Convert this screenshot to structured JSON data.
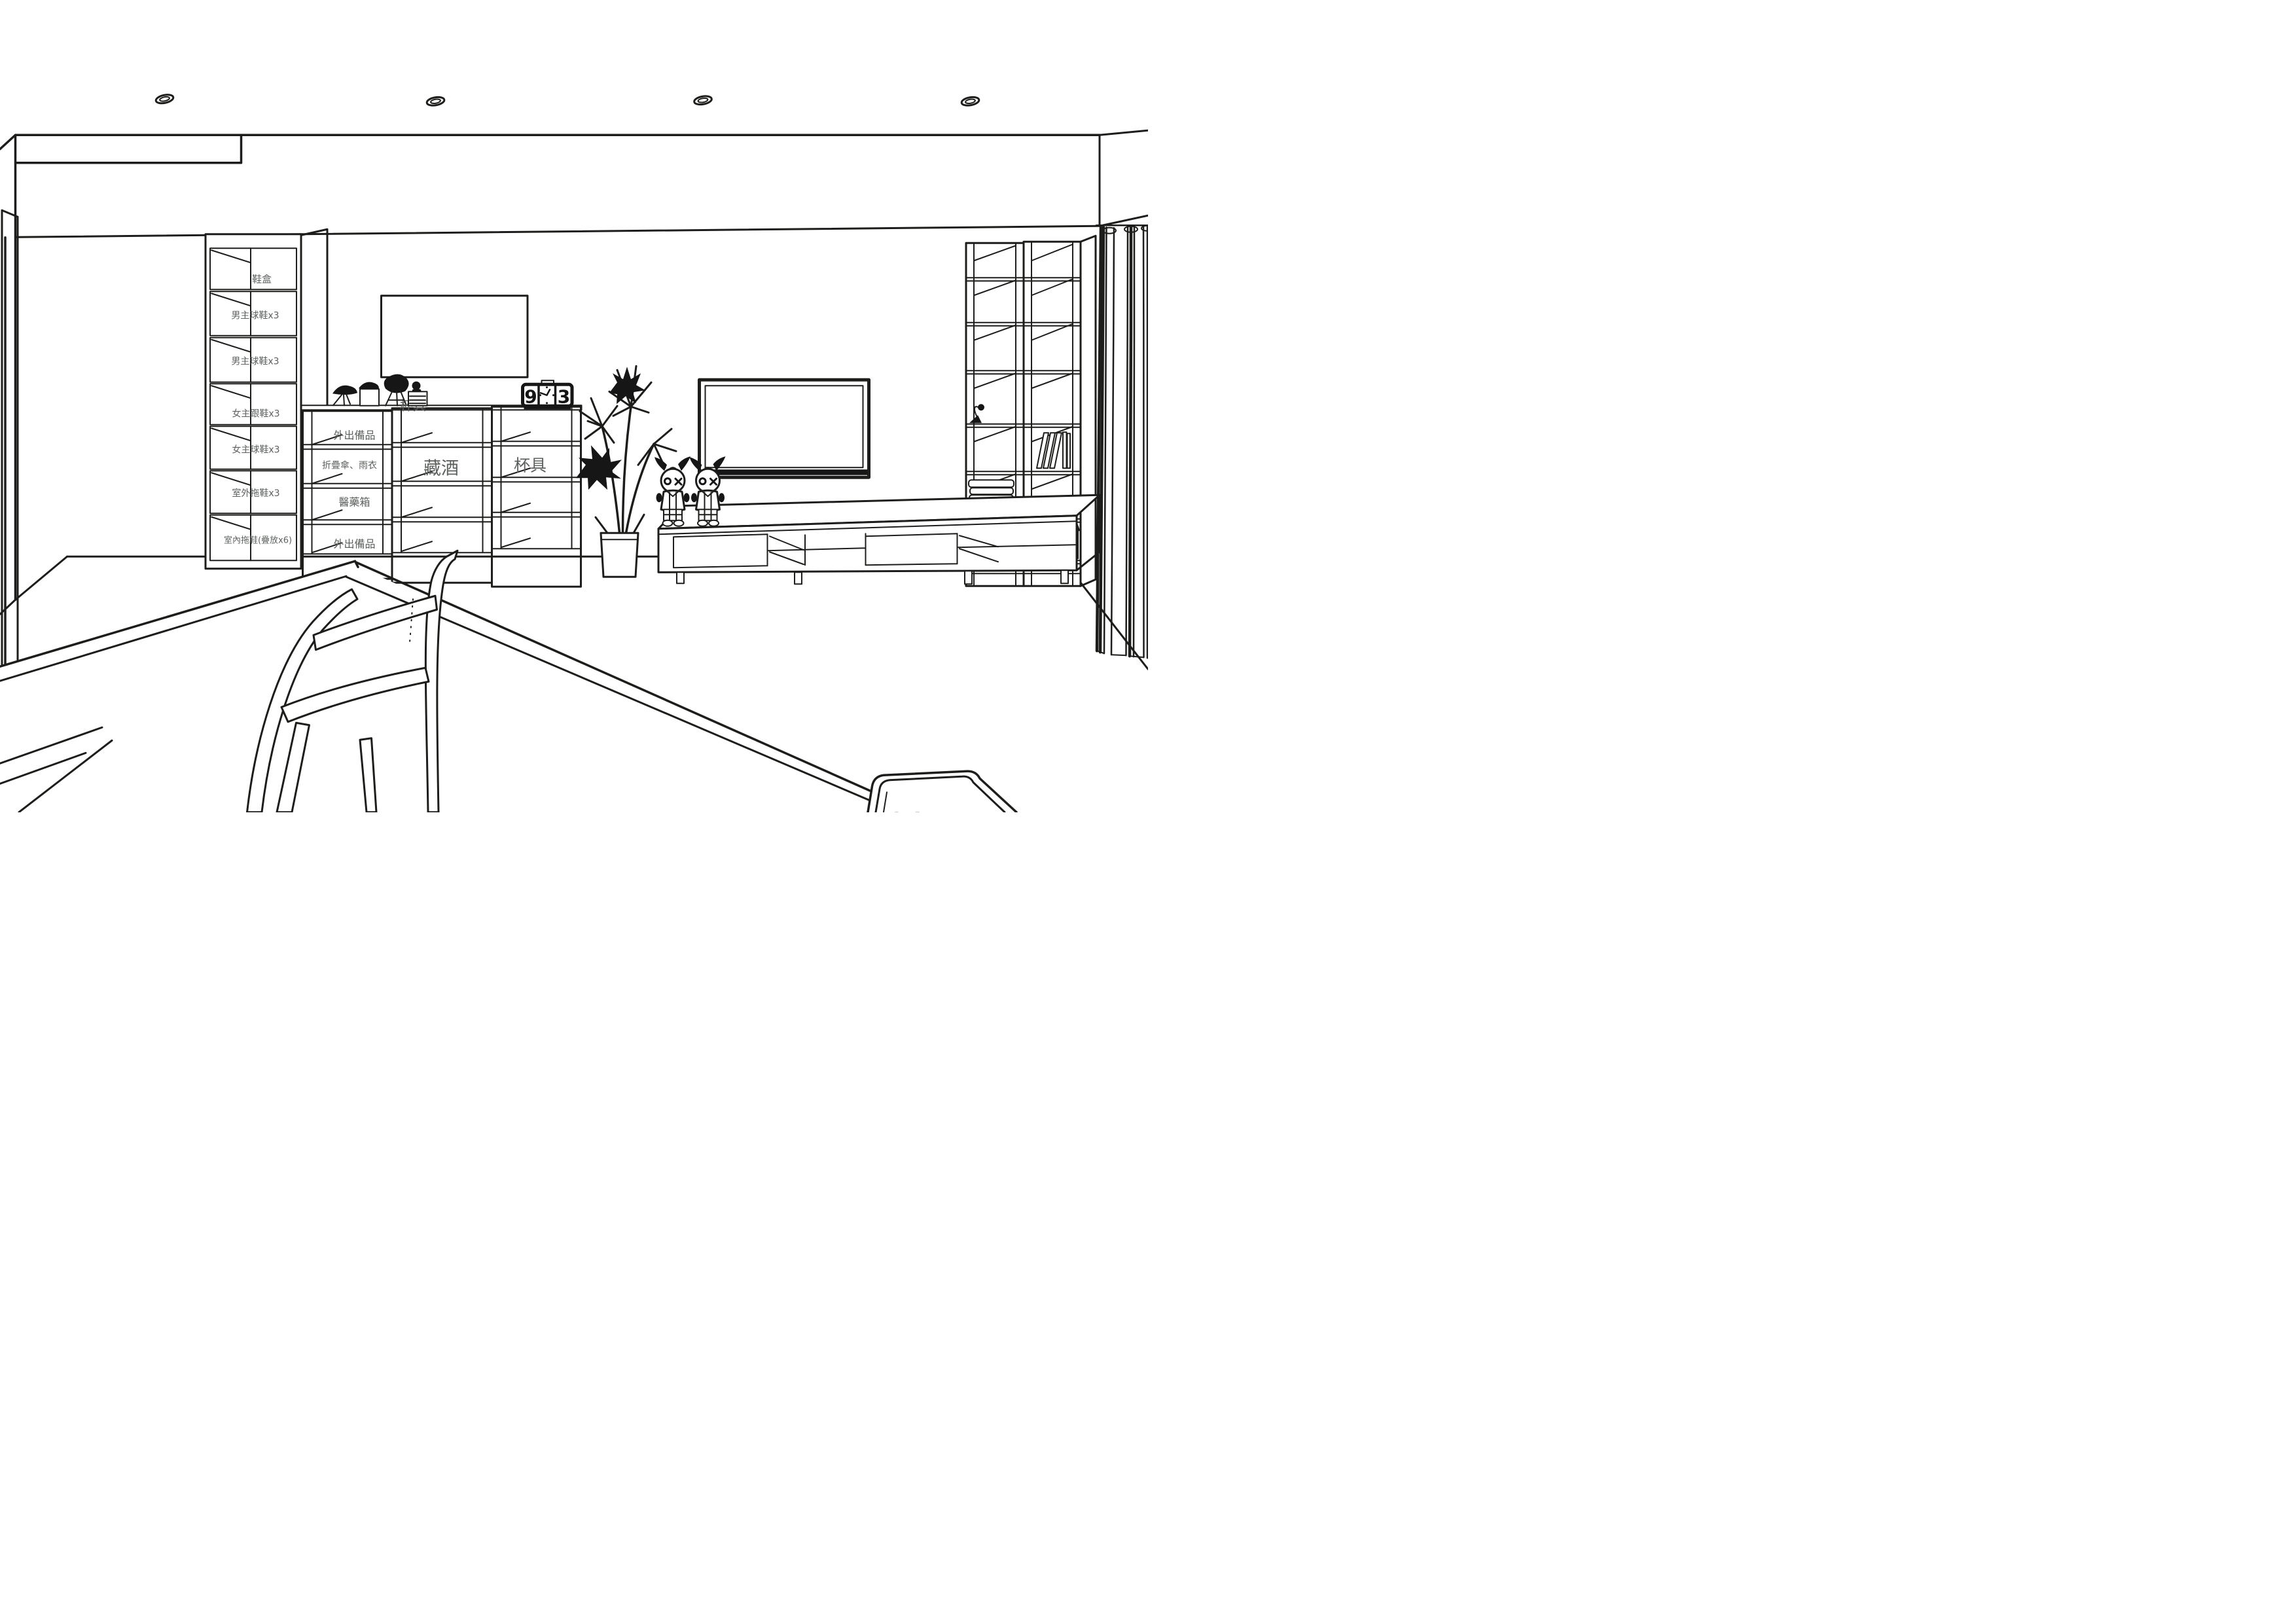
{
  "scene": {
    "title": "Living room interior — line-art design rendering",
    "style": "black & white sketch with tinted storage labels"
  },
  "colors": {
    "paper": "#ffffff",
    "line": "#1d1d1b",
    "label_text": "#5d615e",
    "shelf_green": "#d8e6d9",
    "shelf_tan": "#f5e8d5",
    "shelf_gray": "#f0efed",
    "unit_face": "#f3f2f0"
  },
  "ceiling": {
    "downlights": 4
  },
  "shoe_cabinet": {
    "compartments": [
      {
        "label": "鞋盒",
        "tint": "gray"
      },
      {
        "label": "男主球鞋x3",
        "tint": "green"
      },
      {
        "label": "男主球鞋x3",
        "tint": "green"
      },
      {
        "label": "女主跟鞋x3",
        "tint": "tan"
      },
      {
        "label": "女主球鞋x3",
        "tint": "tan"
      },
      {
        "label": "室外拖鞋x3",
        "tint": "gray"
      },
      {
        "label": "室內拖鞋(疊放x6)",
        "tint": "gray"
      }
    ]
  },
  "storage_shelves": {
    "unit1": {
      "rows": [
        {
          "label": "外出備品"
        },
        {
          "label": "折疊傘、雨衣"
        },
        {
          "label": "醫藥箱"
        },
        {
          "label": "外出備品"
        }
      ]
    },
    "unit2": {
      "label": "藏酒"
    },
    "unit3": {
      "label": "杯具"
    },
    "countertop_label": "杯具",
    "countertop_items": [
      "bird-figurine",
      "bird-figurine-on-cube",
      "abstract-sculpture",
      "seated-figurine"
    ]
  },
  "flip_clock": {
    "hour_digit": "9",
    "minute_digit": "3",
    "center": "analog-face"
  },
  "wall": {
    "artwork": "blank framed picture",
    "tv": "wall-mounted flat screen TV"
  },
  "decor": {
    "plant": "tall potted palm",
    "dolls": [
      "plush doll with O-X eyes",
      "plush doll with O-X eyes"
    ]
  },
  "tv_console": {
    "sections": [
      "closed door",
      "open shelf with divider",
      "closed door",
      "open shelf"
    ],
    "legs": 4
  },
  "bookshelf": {
    "columns": 2,
    "items": [
      "desk-lamp",
      "books-row",
      "folded-blankets",
      "document-box",
      "storage-bin",
      "storage-bin"
    ]
  },
  "window": {
    "curtain": "floor-length grommet curtain"
  },
  "furniture": {
    "dining_table": "wood dining table (foreground)",
    "chair": "wood chair (foreground)",
    "coffee_table": "low table (bottom right)"
  }
}
